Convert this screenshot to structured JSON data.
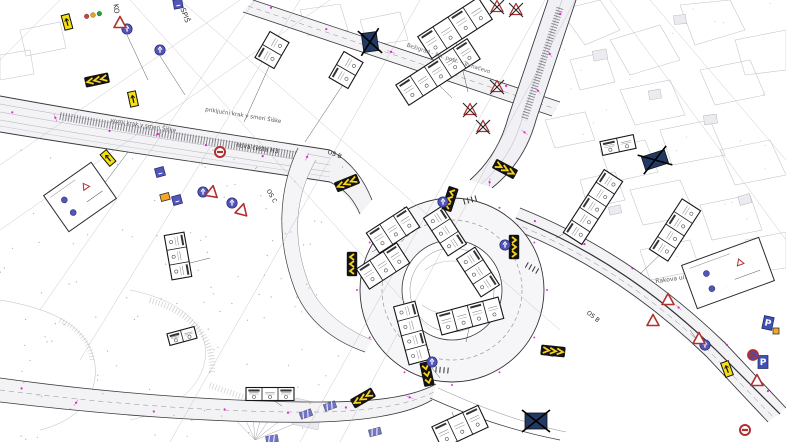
{
  "drawing": {
    "kind": "traffic-signage-site-plan",
    "palette": {
      "chevron_yellow": "#f7d21e",
      "chevron_black": "#141414",
      "sign_blue": "#5156b8",
      "sign_blue_dark": "#23266e",
      "warning_red": "#b03030",
      "marking_magenta": "#d916c8",
      "panel_yellow": "#f5e013",
      "panel_orange": "#f5a623",
      "removed_navy": "#223a63",
      "parking_blue": "#3f51b5",
      "traffic_light_red": "#e53935",
      "traffic_light_amber": "#f5a800",
      "traffic_light_green": "#2e9e3f",
      "table_border": "#16161a",
      "road_edge": "#3a3a3e",
      "parcel_gray": "#c2c3cc"
    },
    "labels": [
      {
        "text": "priključni krak v smeri Šiške",
        "x": 243,
        "y": 117,
        "rot": 9,
        "size": 5.5,
        "color": "#555"
      },
      {
        "text": "vozni krak v smeri Šiške",
        "x": 143,
        "y": 127,
        "rot": 9,
        "size": 5.5,
        "color": "#555"
      },
      {
        "text": "nova cesta H3",
        "x": 257,
        "y": 150,
        "rot": 9,
        "size": 6,
        "color": "#333"
      },
      {
        "text": "Bežigrad - žel. post. - Tomačevo",
        "x": 448,
        "y": 60,
        "rot": 18,
        "size": 5.5,
        "color": "#666"
      },
      {
        "text": "OS B",
        "x": 334,
        "y": 156,
        "rot": 20,
        "size": 6,
        "color": "#222"
      },
      {
        "text": "OS C",
        "x": 270,
        "y": 197,
        "rot": 60,
        "size": 6,
        "color": "#222"
      },
      {
        "text": "OS B",
        "x": 592,
        "y": 318,
        "rot": 38,
        "size": 6,
        "color": "#222"
      },
      {
        "text": "Rakova ul.",
        "x": 671,
        "y": 281,
        "rot": -8,
        "size": 6,
        "color": "#555"
      },
      {
        "text": "SPIŠ",
        "x": 183,
        "y": 16,
        "rot": 70,
        "size": 7,
        "color": "#333"
      },
      {
        "text": "KO",
        "x": 114,
        "y": 9,
        "rot": 82,
        "size": 7,
        "color": "#333"
      }
    ],
    "signs": [
      {
        "name": "chevron-board",
        "type": "chevron",
        "orient": "h",
        "dir": "left",
        "x": 97,
        "y": 80,
        "rot": -12
      },
      {
        "name": "chevron-board",
        "type": "chevron",
        "orient": "h",
        "dir": "left",
        "x": 347,
        "y": 183,
        "rot": -22
      },
      {
        "name": "chevron-board",
        "type": "chevron",
        "orient": "h",
        "dir": "right",
        "x": 505,
        "y": 169,
        "rot": 28
      },
      {
        "name": "chevron-board",
        "type": "chevron",
        "orient": "v",
        "dir": "left",
        "x": 450,
        "y": 199,
        "rot": 18
      },
      {
        "name": "chevron-board",
        "type": "chevron",
        "orient": "v",
        "dir": "right",
        "x": 514,
        "y": 247,
        "rot": 0
      },
      {
        "name": "chevron-board",
        "type": "chevron",
        "orient": "v",
        "dir": "left",
        "x": 352,
        "y": 264,
        "rot": 0
      },
      {
        "name": "chevron-board",
        "type": "chevron",
        "orient": "v",
        "dir": "down",
        "x": 427,
        "y": 374,
        "rot": -12
      },
      {
        "name": "chevron-board",
        "type": "chevron",
        "orient": "h",
        "dir": "left",
        "x": 363,
        "y": 398,
        "rot": -30
      },
      {
        "name": "chevron-board",
        "type": "chevron",
        "orient": "h",
        "dir": "right",
        "x": 553,
        "y": 351,
        "rot": 6
      },
      {
        "name": "mandatory-direction-sign",
        "type": "blue-circle",
        "x": 127,
        "y": 29,
        "rot": 0
      },
      {
        "name": "mandatory-direction-sign",
        "type": "blue-circle",
        "x": 160,
        "y": 50,
        "rot": 0
      },
      {
        "name": "mandatory-direction-sign",
        "type": "blue-circle",
        "x": 203,
        "y": 192,
        "rot": 0
      },
      {
        "name": "mandatory-direction-sign",
        "type": "blue-circle",
        "x": 232,
        "y": 203,
        "rot": 0
      },
      {
        "name": "mandatory-direction-sign",
        "type": "blue-circle",
        "x": 443,
        "y": 202,
        "rot": 0
      },
      {
        "name": "mandatory-direction-sign",
        "type": "blue-circle",
        "x": 505,
        "y": 245,
        "rot": 0
      },
      {
        "name": "mandatory-direction-sign",
        "type": "blue-circle",
        "x": 432,
        "y": 362,
        "rot": 0
      },
      {
        "name": "mandatory-direction-sign",
        "type": "blue-circle",
        "x": 705,
        "y": 345,
        "rot": 0
      },
      {
        "name": "info-sign",
        "type": "blue-square",
        "x": 178,
        "y": 4,
        "rot": -10
      },
      {
        "name": "info-sign",
        "type": "blue-square",
        "x": 160,
        "y": 172,
        "rot": -15
      },
      {
        "name": "info-sign",
        "type": "blue-square",
        "x": 177,
        "y": 200,
        "rot": -15
      },
      {
        "name": "parking-sign",
        "type": "parking",
        "label": "P",
        "x": 768,
        "y": 323,
        "rot": 12
      },
      {
        "name": "parking-sign",
        "type": "parking",
        "label": "P",
        "x": 763,
        "y": 362,
        "rot": 0
      },
      {
        "name": "supplementary-panel",
        "type": "yellow-panel",
        "x": 67,
        "y": 22,
        "rot": -15
      },
      {
        "name": "supplementary-panel",
        "type": "yellow-panel",
        "x": 133,
        "y": 99,
        "rot": -12
      },
      {
        "name": "supplementary-panel",
        "type": "yellow-panel",
        "x": 108,
        "y": 158,
        "rot": -40
      },
      {
        "name": "supplementary-panel",
        "type": "yellow-panel",
        "x": 727,
        "y": 369,
        "rot": -20
      },
      {
        "name": "work-zone-panel",
        "type": "orange-panel",
        "x": 165,
        "y": 197,
        "rot": -15,
        "w": 9,
        "h": 7
      },
      {
        "name": "work-zone-panel",
        "type": "orange-panel",
        "x": 776,
        "y": 331,
        "rot": 0,
        "w": 6,
        "h": 6
      },
      {
        "name": "warning-triangle-sign",
        "type": "red-triangle",
        "x": 120,
        "y": 23,
        "rot": 0
      },
      {
        "name": "warning-triangle-sign",
        "type": "red-triangle",
        "x": 212,
        "y": 192,
        "rot": 10
      },
      {
        "name": "warning-triangle-sign",
        "type": "red-triangle",
        "x": 242,
        "y": 210,
        "rot": 15
      },
      {
        "name": "warning-triangle-sign",
        "type": "red-triangle",
        "x": 668,
        "y": 300,
        "rot": 0
      },
      {
        "name": "warning-triangle-sign",
        "type": "red-triangle",
        "x": 653,
        "y": 321,
        "rot": 0
      },
      {
        "name": "warning-triangle-sign",
        "type": "red-triangle",
        "x": 699,
        "y": 339,
        "rot": 0
      },
      {
        "name": "warning-triangle-sign",
        "type": "red-triangle",
        "x": 757,
        "y": 381,
        "rot": 0
      },
      {
        "name": "removed-warning-sign",
        "type": "red-triangle-x",
        "x": 497,
        "y": 7,
        "rot": 0
      },
      {
        "name": "removed-warning-sign",
        "type": "red-triangle-x",
        "x": 516,
        "y": 10,
        "rot": 0
      },
      {
        "name": "removed-warning-sign",
        "type": "red-triangle-x",
        "x": 497,
        "y": 87,
        "rot": 0
      },
      {
        "name": "removed-warning-sign",
        "type": "red-triangle-x",
        "x": 470,
        "y": 110,
        "rot": 0
      },
      {
        "name": "removed-warning-sign",
        "type": "red-triangle-x",
        "x": 483,
        "y": 127,
        "rot": 0
      },
      {
        "name": "removed-sign",
        "type": "navy-x",
        "x": 370,
        "y": 42,
        "rot": -8,
        "w": 15,
        "h": 19
      },
      {
        "name": "removed-sign",
        "type": "navy-x",
        "x": 655,
        "y": 160,
        "rot": -18,
        "w": 24,
        "h": 14
      },
      {
        "name": "removed-sign",
        "type": "navy-x",
        "x": 536,
        "y": 421,
        "rot": 0,
        "w": 22,
        "h": 16
      },
      {
        "name": "no-entry-sign",
        "type": "no-entry",
        "x": 220,
        "y": 152,
        "rot": 0
      },
      {
        "name": "no-entry-sign",
        "type": "no-entry",
        "x": 745,
        "y": 430,
        "rot": 0
      },
      {
        "name": "no-stopping-sign",
        "type": "no-stopping",
        "x": 753,
        "y": 355,
        "rot": 0
      },
      {
        "name": "traffic-light",
        "type": "traffic-light",
        "x": 93,
        "y": 15,
        "rot": -12
      },
      {
        "name": "road-marking-symbol",
        "type": "marking",
        "x": 306,
        "y": 414,
        "rot": -20
      },
      {
        "name": "road-marking-symbol",
        "type": "marking",
        "x": 330,
        "y": 406,
        "rot": -20
      },
      {
        "name": "road-marking-symbol",
        "type": "marking",
        "x": 375,
        "y": 432,
        "rot": -15
      },
      {
        "name": "road-marking-symbol",
        "type": "marking",
        "x": 272,
        "y": 439,
        "rot": -10
      }
    ],
    "sign_tables": [
      {
        "x": 455,
        "y": 28,
        "rot": -33,
        "cells": 4,
        "cw": 18,
        "ch": 26
      },
      {
        "x": 438,
        "y": 72,
        "rot": -33,
        "cells": 5,
        "cw": 17,
        "ch": 24
      },
      {
        "x": 272,
        "y": 50,
        "rot": -60,
        "cells": 2,
        "cw": 15,
        "ch": 22
      },
      {
        "x": 346,
        "y": 70,
        "rot": -60,
        "cells": 2,
        "cw": 15,
        "ch": 22
      },
      {
        "x": 393,
        "y": 230,
        "rot": -33,
        "cells": 3,
        "cw": 16,
        "ch": 24
      },
      {
        "x": 383,
        "y": 266,
        "rot": -33,
        "cells": 3,
        "cw": 16,
        "ch": 24
      },
      {
        "x": 445,
        "y": 231,
        "rot": 57,
        "cells": 3,
        "cw": 15,
        "ch": 22
      },
      {
        "x": 478,
        "y": 272,
        "rot": 57,
        "cells": 3,
        "cw": 15,
        "ch": 22
      },
      {
        "x": 593,
        "y": 207,
        "rot": -57,
        "cells": 5,
        "cw": 15,
        "ch": 22
      },
      {
        "x": 675,
        "y": 230,
        "rot": -57,
        "cells": 4,
        "cw": 15,
        "ch": 22
      },
      {
        "x": 470,
        "y": 316,
        "rot": -15,
        "cells": 4,
        "cw": 16,
        "ch": 22
      },
      {
        "x": 412,
        "y": 333,
        "rot": 75,
        "cells": 4,
        "cw": 15,
        "ch": 22
      },
      {
        "x": 270,
        "y": 394,
        "rot": 0,
        "cells": 3,
        "cw": 16,
        "ch": 13
      },
      {
        "x": 460,
        "y": 427,
        "rot": -25,
        "cells": 3,
        "cw": 17,
        "ch": 24
      },
      {
        "x": 618,
        "y": 145,
        "rot": -12,
        "cells": 2,
        "cw": 17,
        "ch": 14
      },
      {
        "x": 178,
        "y": 256,
        "rot": 80,
        "cells": 3,
        "cw": 15,
        "ch": 20
      },
      {
        "x": 182,
        "y": 336,
        "rot": -15,
        "cells": 2,
        "cw": 14,
        "ch": 12
      }
    ],
    "detail_boxes": [
      {
        "x": 80,
        "y": 197,
        "w": 58,
        "h": 44,
        "rot": -35
      },
      {
        "x": 728,
        "y": 273,
        "w": 82,
        "h": 46,
        "rot": -20
      }
    ]
  }
}
